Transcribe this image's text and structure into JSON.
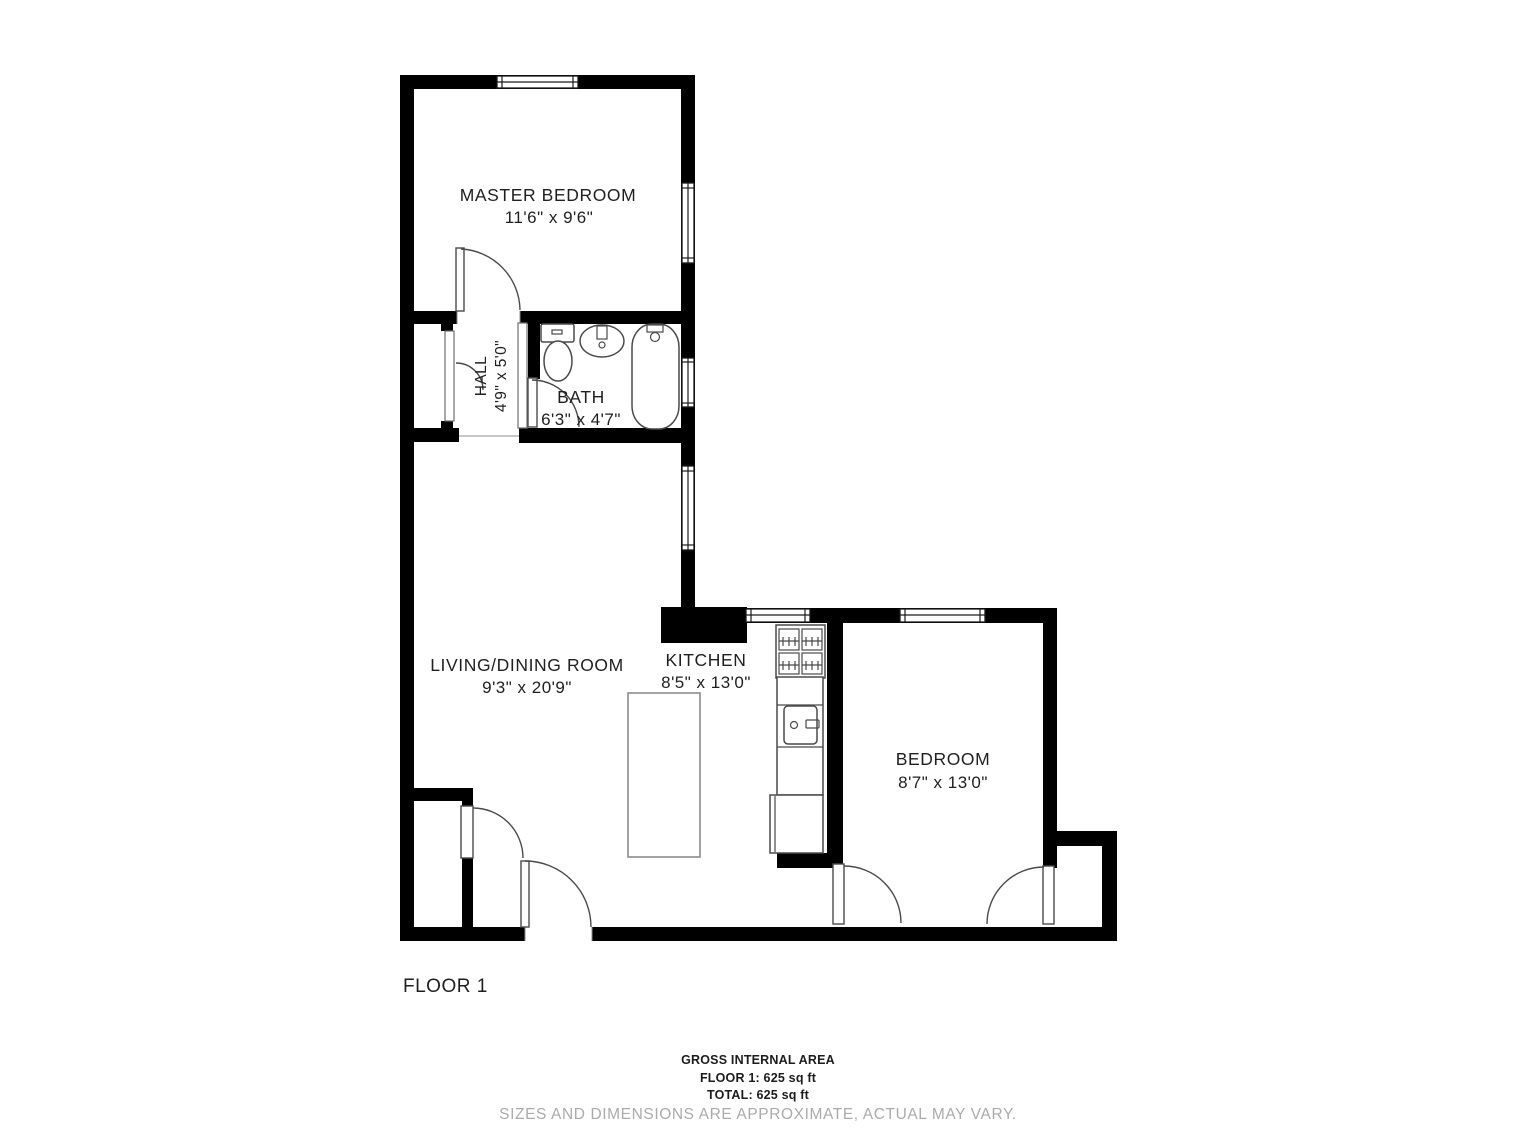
{
  "floor_label": "FLOOR 1",
  "rooms": {
    "master": {
      "name": "MASTER BEDROOM",
      "dims": "11'6\" x 9'6\""
    },
    "hall": {
      "name": "HALL",
      "dims": "4'9\" x 5'0\""
    },
    "bath": {
      "name": "BATH",
      "dims": "6'3\" x 4'7\""
    },
    "living": {
      "name": "LIVING/DINING ROOM",
      "dims": "9'3\" x 20'9\""
    },
    "kitchen": {
      "name": "KITCHEN",
      "dims": "8'5\" x 13'0\""
    },
    "bedroom": {
      "name": "BEDROOM",
      "dims": "8'7\" x 13'0\""
    }
  },
  "footer": {
    "area_title": "GROSS INTERNAL AREA",
    "floor_area": "FLOOR 1: 625 sq ft",
    "total_area": "TOTAL: 625 sq ft",
    "disclaimer": "SIZES AND DIMENSIONS ARE APPROXIMATE, ACTUAL MAY VARY."
  },
  "colors": {
    "wall": "#000000",
    "fixture": "#4a4a4a",
    "ink": "#1f1f1f",
    "muted": "#ababab"
  }
}
